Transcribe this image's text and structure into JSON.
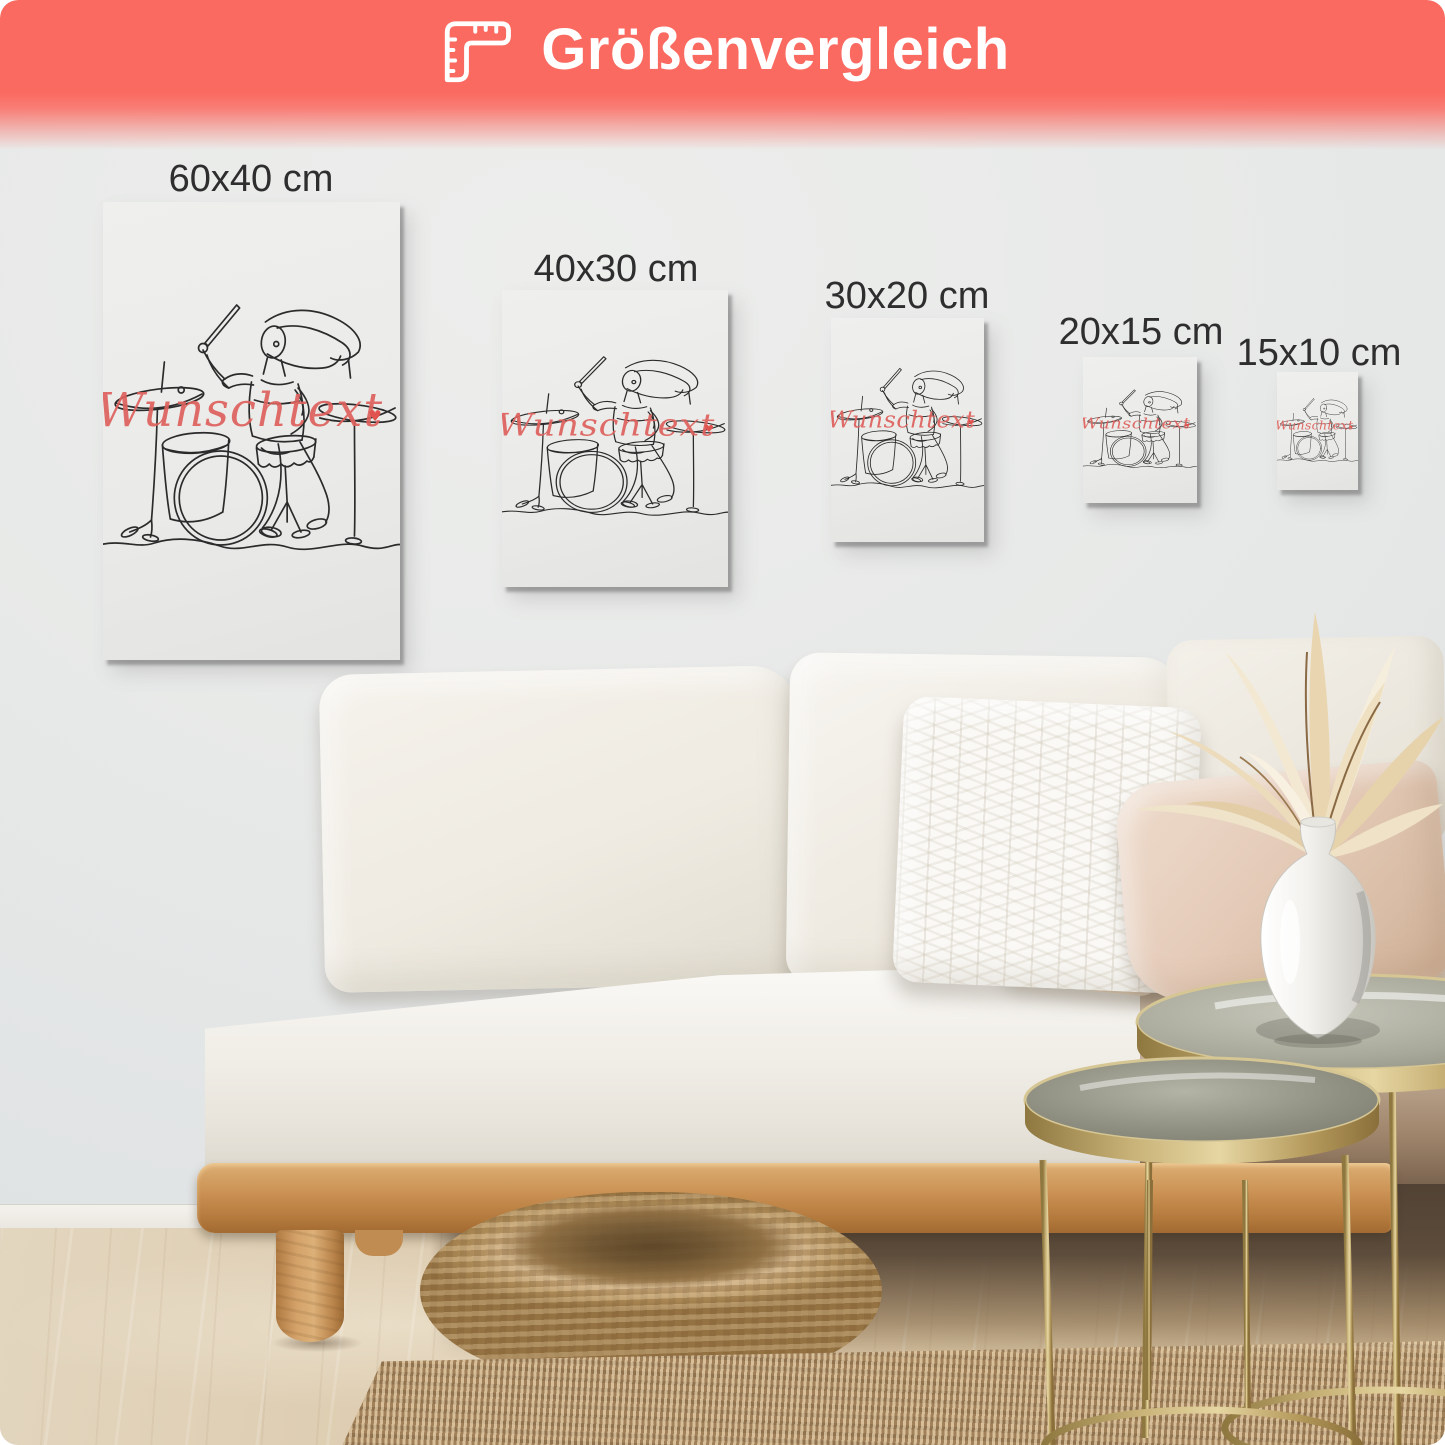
{
  "banner": {
    "title": "Größenvergleich",
    "icon": "ruler-icon",
    "background_color": "#fb6a61",
    "text_color": "#ffffff"
  },
  "size_labels": [
    "60x40 cm",
    "40x30 cm",
    "30x20 cm",
    "20x15 cm",
    "15x10 cm"
  ],
  "poster": {
    "wishtext": "Wunschtext",
    "heart": "♥",
    "line_color": "#2b2b2b",
    "accent_color": "#dd615c",
    "subject": "line-art drummer girl"
  }
}
